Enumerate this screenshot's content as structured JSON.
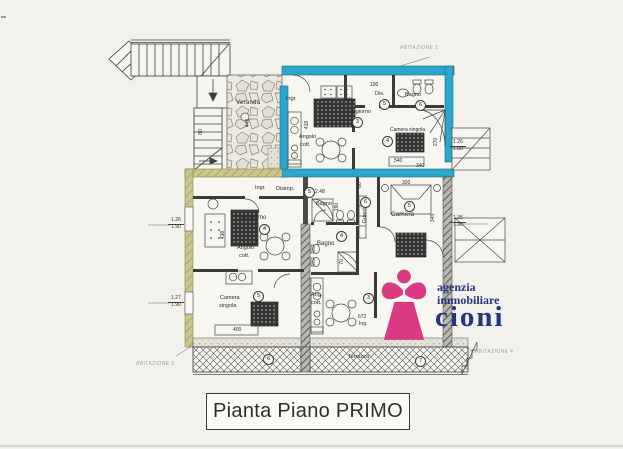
{
  "document": {
    "caption": "Pianta Piano PRIMO"
  },
  "logo": {
    "line1": "agenzia",
    "line2": "immobiliare",
    "name": "cioni"
  },
  "colors": {
    "apartment_wall_cyan": "#2da6cb",
    "outer_wall_olive": "#c9c489",
    "logo_magenta": "#d93a82",
    "logo_blue": "#27357e"
  },
  "plan": {
    "veranda": {
      "label": "Veranda",
      "dim": "448"
    },
    "stair_dim": "80",
    "apt5": {
      "label": "ABITAZIONE 5",
      "ingresso": "Ingr.",
      "soggiorno": "Soggiorno",
      "soggiorno_no": "3",
      "angolo_1": "Angolo",
      "angolo_2": "cott.",
      "dis": "Dis.",
      "dis_no": "5",
      "bagno": "Bagno",
      "bagno_no": "6",
      "camera": "Camera singola",
      "camera_no": "4",
      "dim_100": "100",
      "dim_418": "418",
      "dim_540": "540",
      "dim_340": "340",
      "dim_270": "270",
      "dim_r1a": "1.26",
      "dim_r1b": "1.80"
    },
    "apt3": {
      "label": "ABITAZIONE 3",
      "ingresso": "Ingr.",
      "disimpegno": "Disimp.",
      "disimpegno_no": "5",
      "dim_248": "2.48",
      "bagno": "Bagno",
      "dim_190": "190",
      "soggiorno": "Soggiorno",
      "soggiorno_no": "4",
      "angolo_1": "Angolo",
      "angolo_2": "cott.",
      "dim_438": "438",
      "camera_1": "Camera",
      "camera_2": "singola",
      "camera_no": "5",
      "dim_400": "400",
      "terrace_no": "6",
      "dim_l1a": "1.26",
      "dim_l1b": "1.90",
      "dim_l2a": "1.27",
      "dim_l2b": "1.90"
    },
    "apt4": {
      "label": "ABITAZIONE 4",
      "camera": "Camera",
      "camera_no": "5",
      "dim_345": "345",
      "dim_320": "320",
      "guardaroba": "Guard.",
      "guardaroba_no": "6",
      "dim_60": "60",
      "bagno": "Bagno",
      "bagno_no": "4",
      "dim_70": "70",
      "angolo_1": "Ang.",
      "angolo_2": "cott.",
      "angolo_no": "3",
      "dim_672": "672",
      "ing": "Ing.",
      "terrazza": "Terrazza",
      "terrazza_no": "7",
      "dim_r2a": "1.35",
      "dim_r2b": "1.00"
    }
  }
}
